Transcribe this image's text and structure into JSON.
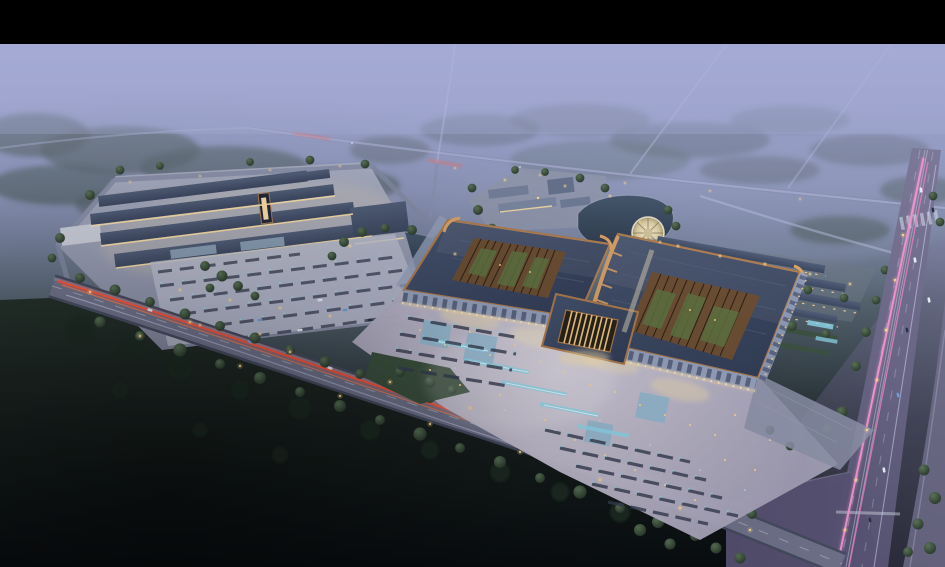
{
  "scene": {
    "type": "architectural-aerial-rendering",
    "time_of_day": "dusk",
    "description": "Letterboxed dusk aerial rendering of a large illuminated commercial campus: twin curved-roof pavilions with open lattice courtyards and a lit gateway, a bright fountain plaza with stall rows, a market-hall complex with parking to the west, row buildings and a round fountain by a lake to the north-east, surrounded by misty fields, forests, a diagonal highway with red tail-light trails and a wide avenue with pink light trails.",
    "elements": [
      "letterbox-top-bar",
      "misty-sky",
      "distant-roads",
      "forest-band",
      "dark-field",
      "market-complex",
      "parking-lot",
      "pond",
      "lake",
      "round-fountain-plaza",
      "hotel-campus",
      "row-buildings",
      "twin-pavilions",
      "lattice-courtyards",
      "gateway-tower",
      "fountain-plaza",
      "stall-rows",
      "highway-red-trails",
      "avenue-pink-trails",
      "street-lamps",
      "trees",
      "cars"
    ]
  },
  "palette": {
    "bar": "#000000",
    "sky-top": "#9499c9",
    "sky-mid": "#7f89ac",
    "sky-low": "#566471",
    "sky-deep": "#232d31",
    "sky-bottom": "#0d1216",
    "mist": "#aab0d8",
    "field-top": "#24302a",
    "field-bottom": "#090d10",
    "forest": "#35463d",
    "forest-green": "#41524a",
    "tree-hi": "#597257",
    "tree-lo": "#1e2a22",
    "tree-dark": "#1d2a22",
    "road-faint": "#b7bcdc",
    "road": "#6e7189",
    "road-casing": "#454b60",
    "road-main": "#7b7898",
    "road-main-low": "#565271",
    "apron": "#595374",
    "ramp": "#767390",
    "lane": "#c9cede",
    "trail-red": "#ff5136",
    "trail-orange": "#ff7a4a",
    "trail-pink": "#f093cc",
    "trail-pink2": "#e87fc0",
    "trail-white": "#d5dcff",
    "pad": "#a9aec2",
    "pad-low": "#878ca4",
    "lot": "#b9bdcf",
    "stall": "#353c50",
    "plaza-hi": "#d8d2e1",
    "plaza-lo": "#a29fb6",
    "glow-warm": "#f6e0ac",
    "light-warm": "#ffd98f",
    "light-cool": "#cfe8f6",
    "column-glow": "#ffe9b8",
    "roof-hi": "#46536f",
    "roof-lo": "#303b54",
    "roof-bar-hi": "#515e78",
    "roof-bar-lo": "#3c4760",
    "ridge": "#7e8aa4",
    "copper": "#ab7a4e",
    "copper-hi": "#d9a266",
    "canopy": "#95a0bc",
    "canopy-dark": "#2c3450",
    "facade-glow": "#f7dca6",
    "lattice": "#6b4e34",
    "lattice-dark": "#241a10",
    "court-green": "#5f7342",
    "water-hi": "#45566c",
    "water-lo": "#2e3b4d",
    "shore": "#c3ccda",
    "fountain": "#8fd9ef",
    "pool": "#7fb8d4",
    "hedge": "#3c5142",
    "lawn": "#3a4f3d",
    "campus-roof": "#737f99",
    "white-wall": "#c9cdd8"
  }
}
